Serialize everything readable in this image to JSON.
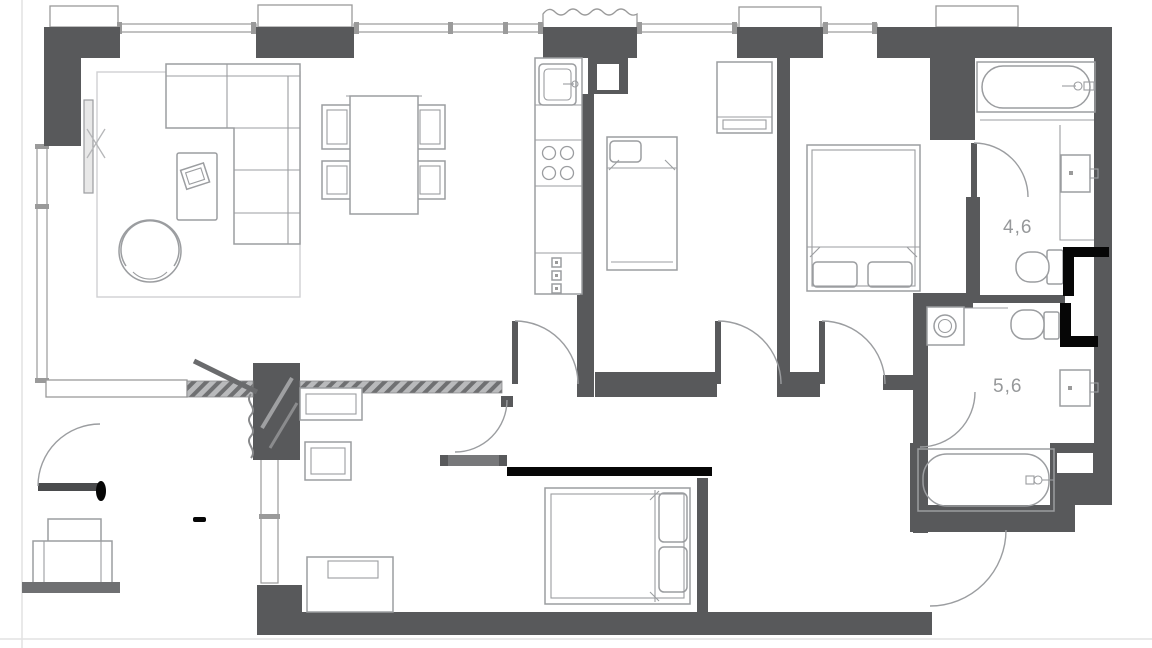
{
  "plan": {
    "type": "apartment-floor-plan",
    "room_area_labels": {
      "bathroom_small": "4,6",
      "bathroom_large": "5,6"
    },
    "colors": {
      "wall": "#58595b",
      "wall_medium": "#77787a",
      "hatch_base": "#b9babc",
      "hatch_stripe": "#6f7072",
      "furniture_line": "#a3a5a7",
      "fixture_line": "#9b9da0",
      "window_line": "#9a9a9a",
      "annotation": "#060606",
      "area_label": "#96989a",
      "background": "#ffffff",
      "page_edge": "#e2e2e2"
    },
    "fixtures": [
      "l-shaped-sofa",
      "coffee-table",
      "lounge-chair",
      "rug",
      "tv",
      "dining-table",
      "dining-chair",
      "kitchen-counter",
      "kitchen-sink",
      "cooktop",
      "single-bed",
      "wardrobe",
      "double-bed",
      "bathtub",
      "washbasin",
      "toilet",
      "washing-machine",
      "desk",
      "dresser",
      "hallway-armchair",
      "door-swing",
      "window"
    ]
  }
}
